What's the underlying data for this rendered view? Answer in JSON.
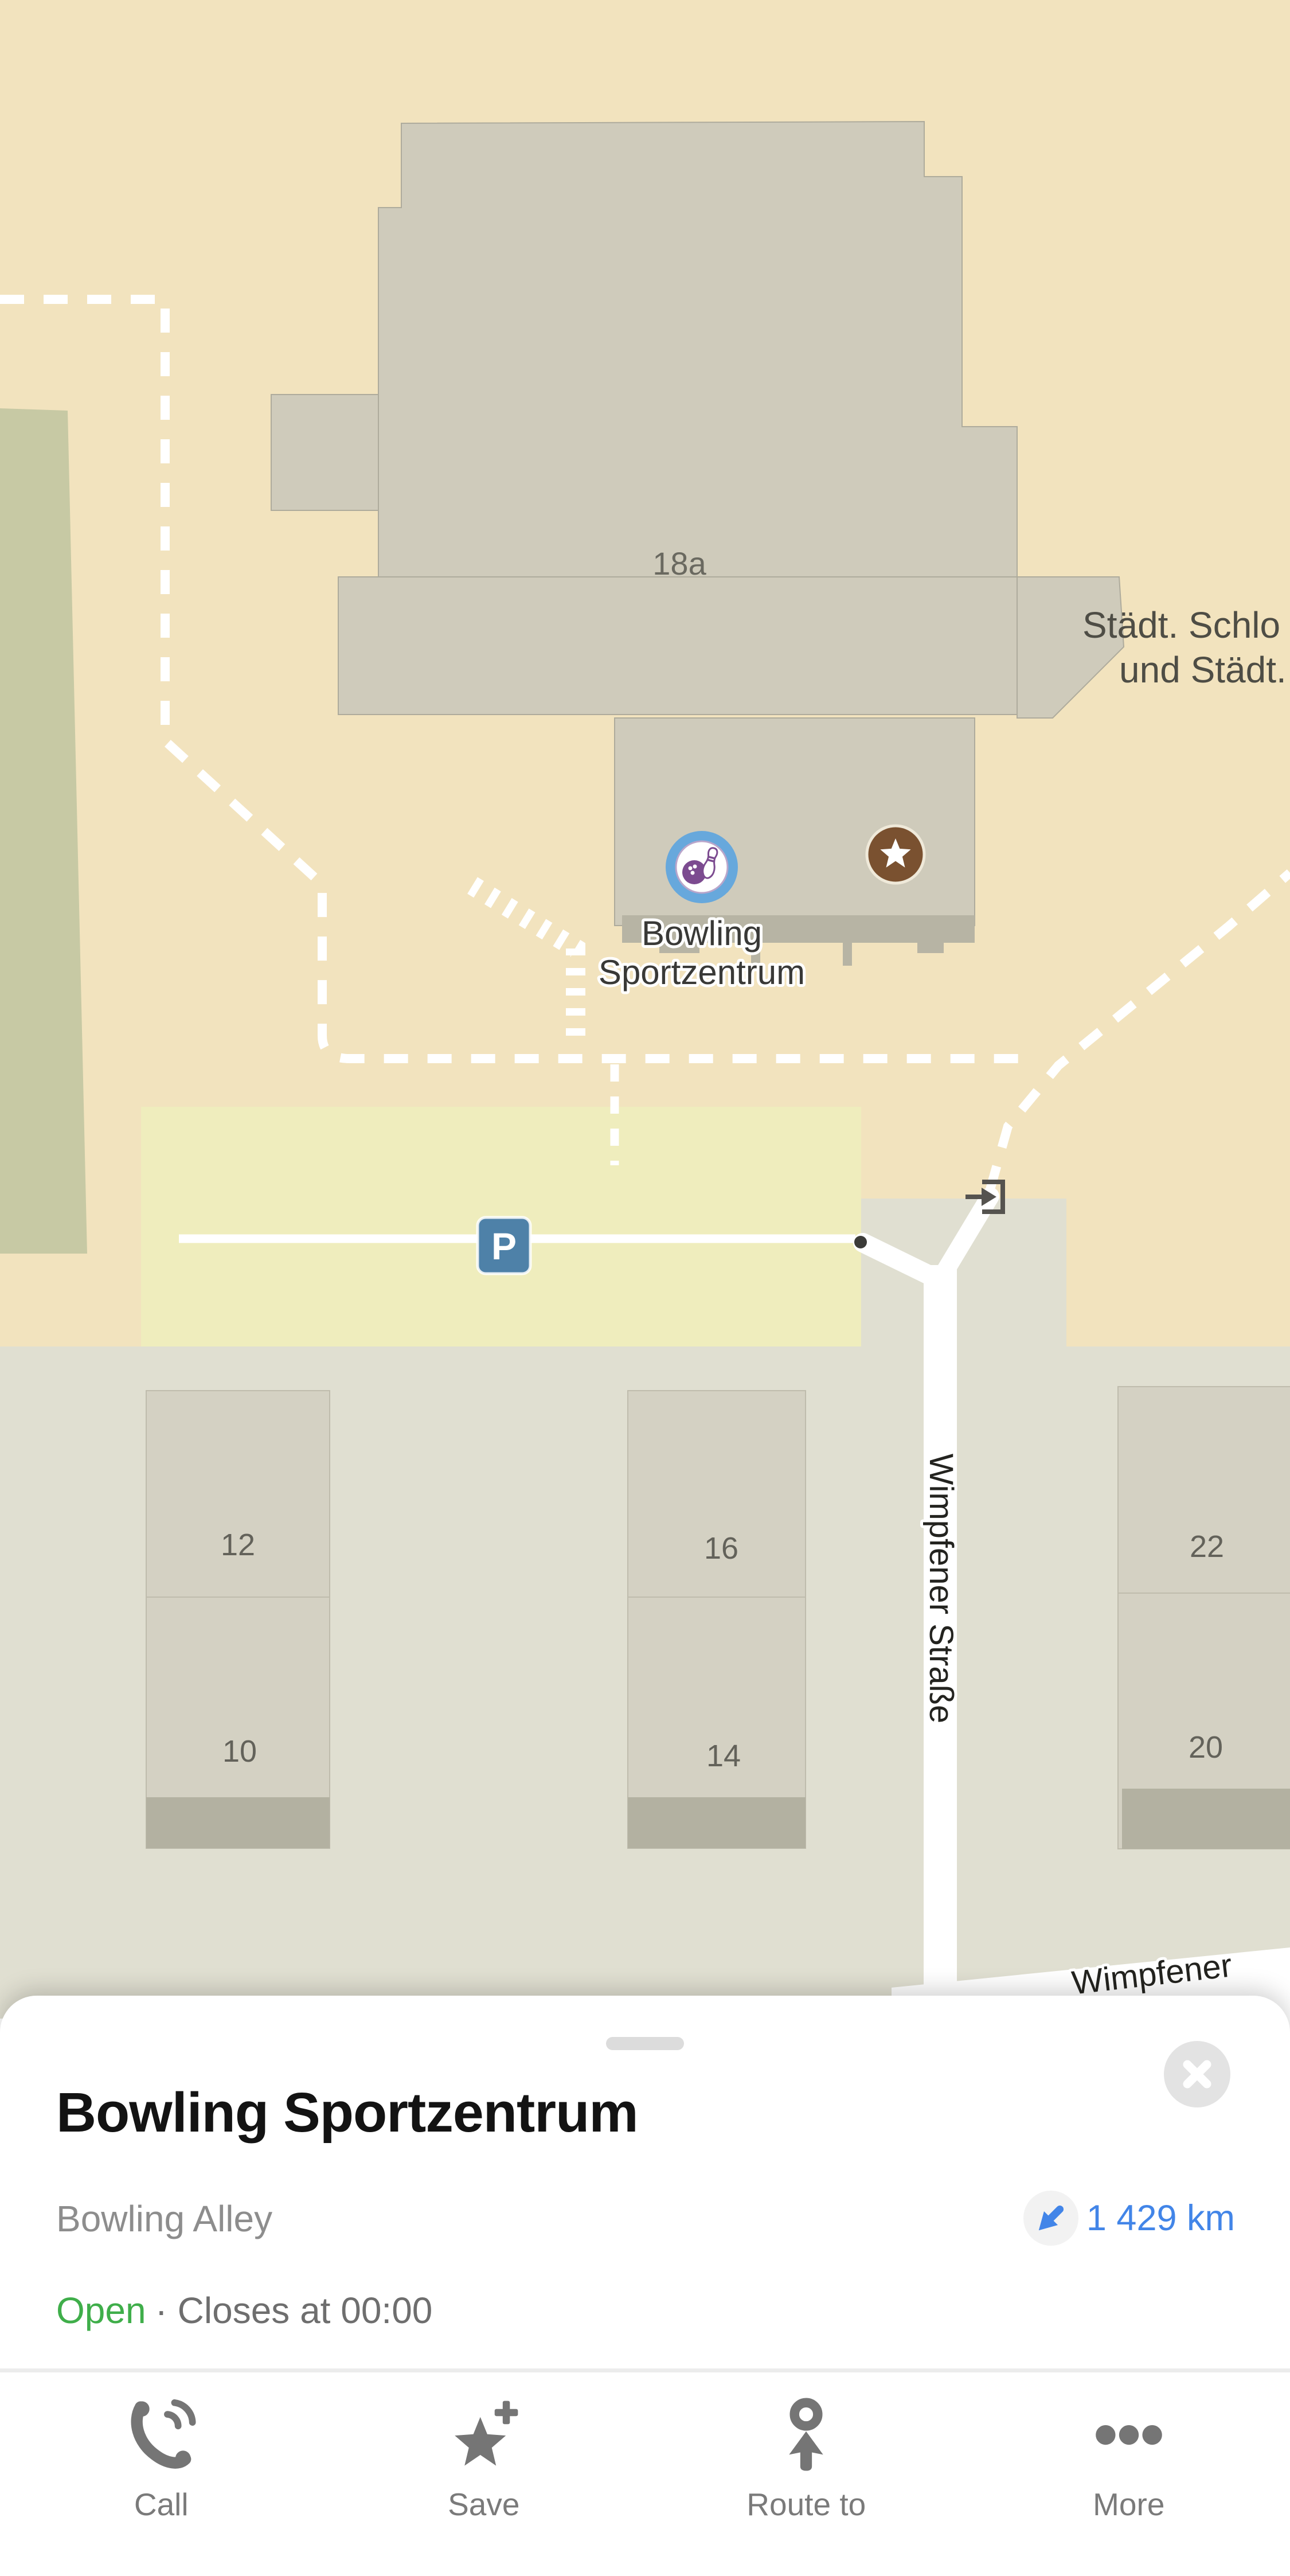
{
  "map": {
    "poi": {
      "label_line1": "Bowling",
      "label_line2": "Sportzentrum"
    },
    "building_number": "18a",
    "area_label_line1": "Städt. Schlo",
    "area_label_line2": "und Städt.",
    "street_vertical": "Wimpfener Straße",
    "street_bottom": "Wimpfener",
    "parking_badge": "P",
    "house_numbers": [
      "12",
      "10",
      "16",
      "14",
      "22",
      "20"
    ]
  },
  "sheet": {
    "title": "Bowling Sportzentrum",
    "category": "Bowling Alley",
    "distance": "1 429 km",
    "status_open": "Open",
    "status_rest": "· Closes at 00:00",
    "actions": [
      {
        "label": "Call"
      },
      {
        "label": "Save"
      },
      {
        "label": "Route to"
      },
      {
        "label": "More"
      }
    ]
  },
  "colors": {
    "map_background": "#F2E3BE",
    "building_fill": "#CFCBBB",
    "lower_zone": "#E0DFD1",
    "parking_area": "#EFEDBD",
    "green_area": "#C7C9A4",
    "accent_blue": "#4285E8",
    "open_green": "#3FAE4A",
    "poi_blue": "#67A8DC",
    "poi_purple": "#7C4B90",
    "star_brown": "#7A5130",
    "parking_badge_blue": "#4E81A8"
  }
}
